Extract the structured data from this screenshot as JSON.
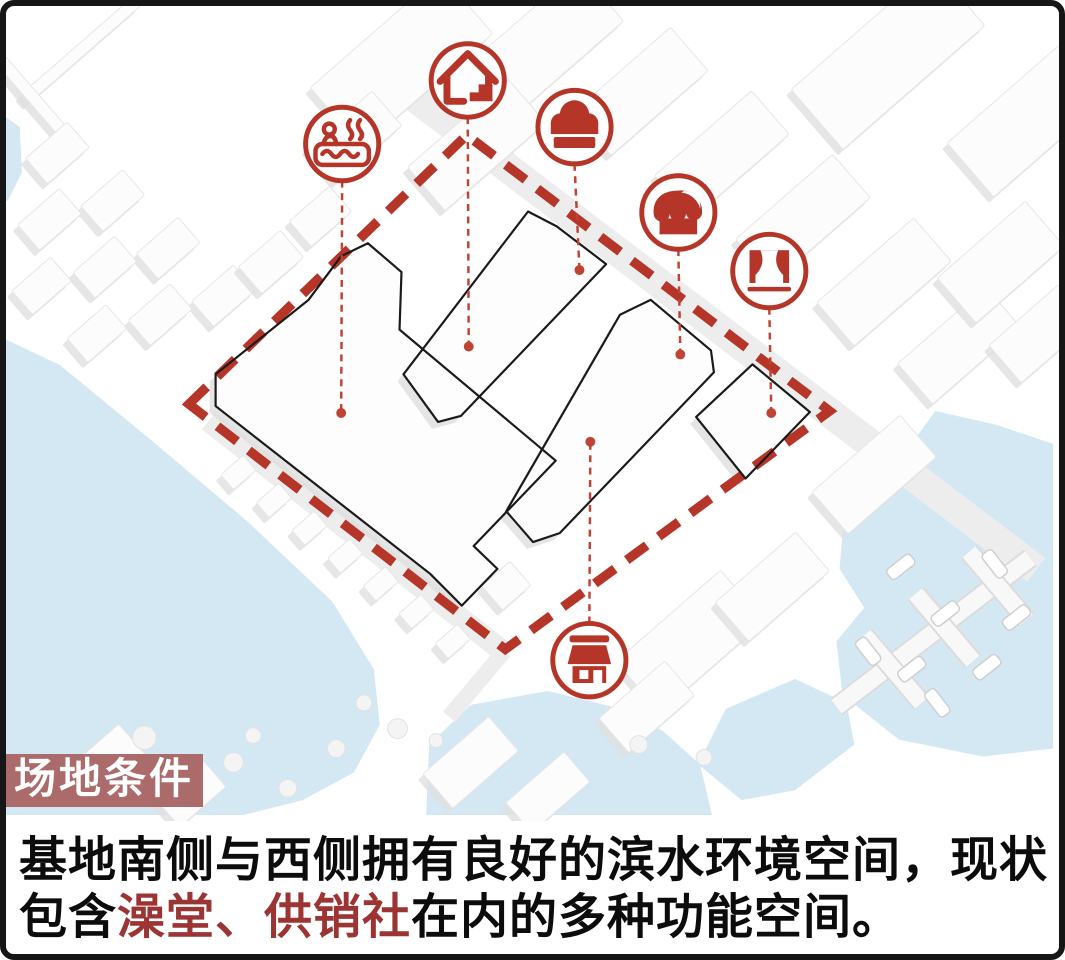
{
  "colors": {
    "accent_red": "#b53629",
    "leader_red": "#bf4433",
    "label_bg": "#ab6b6b",
    "caption_red": "#9c3434",
    "caption_black": "#0c0c0c",
    "water_blue": "#d3e8f3"
  },
  "label": {
    "text": "场地条件"
  },
  "caption": {
    "line1": "基地南侧与西侧拥有良好的滨水环境空间，现状",
    "line2_parts": [
      {
        "text": "包含",
        "emphasis": false
      },
      {
        "text": "澡堂、供销社",
        "emphasis": true
      },
      {
        "text": "在内的多种功能空间。",
        "emphasis": false
      }
    ]
  },
  "icons": [
    {
      "name": "bathhouse-icon",
      "cx": 340,
      "cy": 139,
      "dot_x": 339,
      "dot_y": 410
    },
    {
      "name": "house-icon",
      "cx": 467,
      "cy": 75,
      "dot_x": 468,
      "dot_y": 343
    },
    {
      "name": "chef-hat-icon",
      "cx": 575,
      "cy": 122,
      "dot_x": 580,
      "dot_y": 266
    },
    {
      "name": "market-awning-icon",
      "cx": 680,
      "cy": 208,
      "dot_x": 682,
      "dot_y": 351
    },
    {
      "name": "stage-curtain-icon",
      "cx": 772,
      "cy": 267,
      "dot_x": 774,
      "dot_y": 410
    },
    {
      "name": "storefront-icon",
      "cx": 590,
      "cy": 659,
      "dot_x": 591,
      "dot_y": 439
    }
  ],
  "site": {
    "boundary": [
      [
        185,
        401
      ],
      [
        466,
        130
      ],
      [
        833,
        408
      ],
      [
        505,
        648
      ]
    ],
    "building_outlines": [
      "M306,296 L339,252 L366,239 L400,268 L398,326 L556,458 L473,544 L497,567 L461,604 L429,572 L212,403 L212,371 Z",
      "M402,371 L528,207 L557,222 L607,260 L460,413 L437,419 Z",
      "M506,509 L621,311 L652,296 L713,347 L716,369 L560,531 L533,540 Z",
      "M755,361 L813,409 L748,476 L698,414 Z"
    ]
  },
  "scenery": {
    "water_paths": [
      "M0,112 L14,122 L16,168 L2,196 L0,196 Z",
      "M0,336 L55,362 L150,440 L245,520 L330,600 L372,668 L378,724 L352,772 L300,800 L240,815 L0,815 Z",
      "M425,815 L428,744 L470,704 L548,690 L614,706 L664,730 L702,764 L714,815 Z",
      "M700,764 L728,708 L798,678 L850,702 L858,744 L798,790 L744,800 Z",
      "M940,408 L1002,422 L1059,441 L1059,748 L988,756 L903,739 L846,694 L840,640 L868,606 L843,567 L847,522 L888,477 L918,438 Z"
    ],
    "roads": [
      [
        395,
        78,
        1042,
        568,
        30
      ],
      [
        205,
        418,
        505,
        652,
        22
      ],
      [
        504,
        650,
        448,
        716,
        16
      ]
    ],
    "piers": [
      [
        840,
        706,
        1036,
        556
      ],
      [
        868,
        634,
        926,
        702
      ],
      [
        920,
        592,
        978,
        660
      ],
      [
        974,
        550,
        1032,
        618
      ]
    ],
    "boats": [
      [
        905,
        565,
        -38
      ],
      [
        1000,
        562,
        52
      ],
      [
        950,
        612,
        -38
      ],
      [
        872,
        650,
        52
      ],
      [
        916,
        668,
        -38
      ],
      [
        992,
        666,
        -38
      ],
      [
        942,
        702,
        52
      ],
      [
        1022,
        616,
        -38
      ]
    ],
    "trees": [
      [
        140,
        737,
        12
      ],
      [
        230,
        762,
        10
      ],
      [
        285,
        788,
        9
      ],
      [
        334,
        748,
        9
      ],
      [
        396,
        728,
        10
      ],
      [
        362,
        702,
        8
      ],
      [
        640,
        744,
        9
      ],
      [
        706,
        757,
        8
      ],
      [
        435,
        740,
        7
      ],
      [
        250,
        735,
        8
      ]
    ],
    "blocks": [
      [
        75,
        45,
        150,
        12,
        -41
      ],
      [
        30,
        95,
        110,
        12,
        49
      ],
      [
        52,
        148,
        56,
        34,
        -41
      ],
      [
        108,
        196,
        56,
        34,
        -41
      ],
      [
        164,
        244,
        56,
        34,
        -41
      ],
      [
        220,
        292,
        56,
        34,
        -41
      ],
      [
        44,
        215,
        56,
        34,
        -41
      ],
      [
        100,
        263,
        56,
        34,
        -41
      ],
      [
        156,
        311,
        56,
        34,
        -41
      ],
      [
        36,
        282,
        52,
        32,
        -41
      ],
      [
        92,
        330,
        52,
        32,
        -41
      ],
      [
        268,
        258,
        56,
        36,
        -41
      ],
      [
        318,
        212,
        54,
        34,
        -41
      ],
      [
        400,
        55,
        175,
        80,
        -41
      ],
      [
        545,
        38,
        150,
        70,
        -41
      ],
      [
        352,
        132,
        88,
        46,
        -41
      ],
      [
        476,
        140,
        135,
        58,
        -41
      ],
      [
        642,
        86,
        130,
        58,
        -41
      ],
      [
        724,
        150,
        130,
        58,
        -41
      ],
      [
        806,
        214,
        130,
        58,
        -41
      ],
      [
        888,
        278,
        130,
        58,
        -41
      ],
      [
        964,
        342,
        118,
        54,
        -41
      ],
      [
        892,
        52,
        190,
        80,
        -41
      ],
      [
        1032,
        116,
        150,
        72,
        -41
      ],
      [
        1006,
        258,
        118,
        60,
        -41
      ],
      [
        1046,
        330,
        94,
        50,
        -41
      ],
      [
        878,
        472,
        118,
        56,
        -41
      ],
      [
        692,
        640,
        140,
        68,
        -41
      ],
      [
        775,
        585,
        108,
        52,
        -41
      ],
      [
        648,
        706,
        88,
        46,
        -41
      ],
      [
        470,
        762,
        88,
        46,
        -41
      ],
      [
        548,
        792,
        78,
        40,
        -41
      ],
      [
        235,
        470,
        30,
        20,
        -41
      ],
      [
        271,
        498,
        30,
        20,
        -41
      ],
      [
        307,
        526,
        30,
        20,
        -41
      ],
      [
        343,
        554,
        30,
        20,
        -41
      ],
      [
        379,
        582,
        30,
        20,
        -41
      ],
      [
        415,
        610,
        30,
        20,
        -41
      ],
      [
        452,
        640,
        30,
        20,
        -41
      ],
      [
        322,
        382,
        44,
        32,
        -41
      ],
      [
        384,
        444,
        46,
        34,
        -41
      ],
      [
        444,
        504,
        44,
        32,
        -41
      ],
      [
        100,
        762,
        72,
        40,
        -41
      ],
      [
        188,
        794,
        62,
        34,
        -41
      ],
      [
        755,
        416,
        64,
        60,
        -41
      ],
      [
        506,
        584,
        38,
        32,
        -41
      ]
    ],
    "faint_lines": [
      [
        267,
        434,
        451,
        349
      ]
    ]
  }
}
